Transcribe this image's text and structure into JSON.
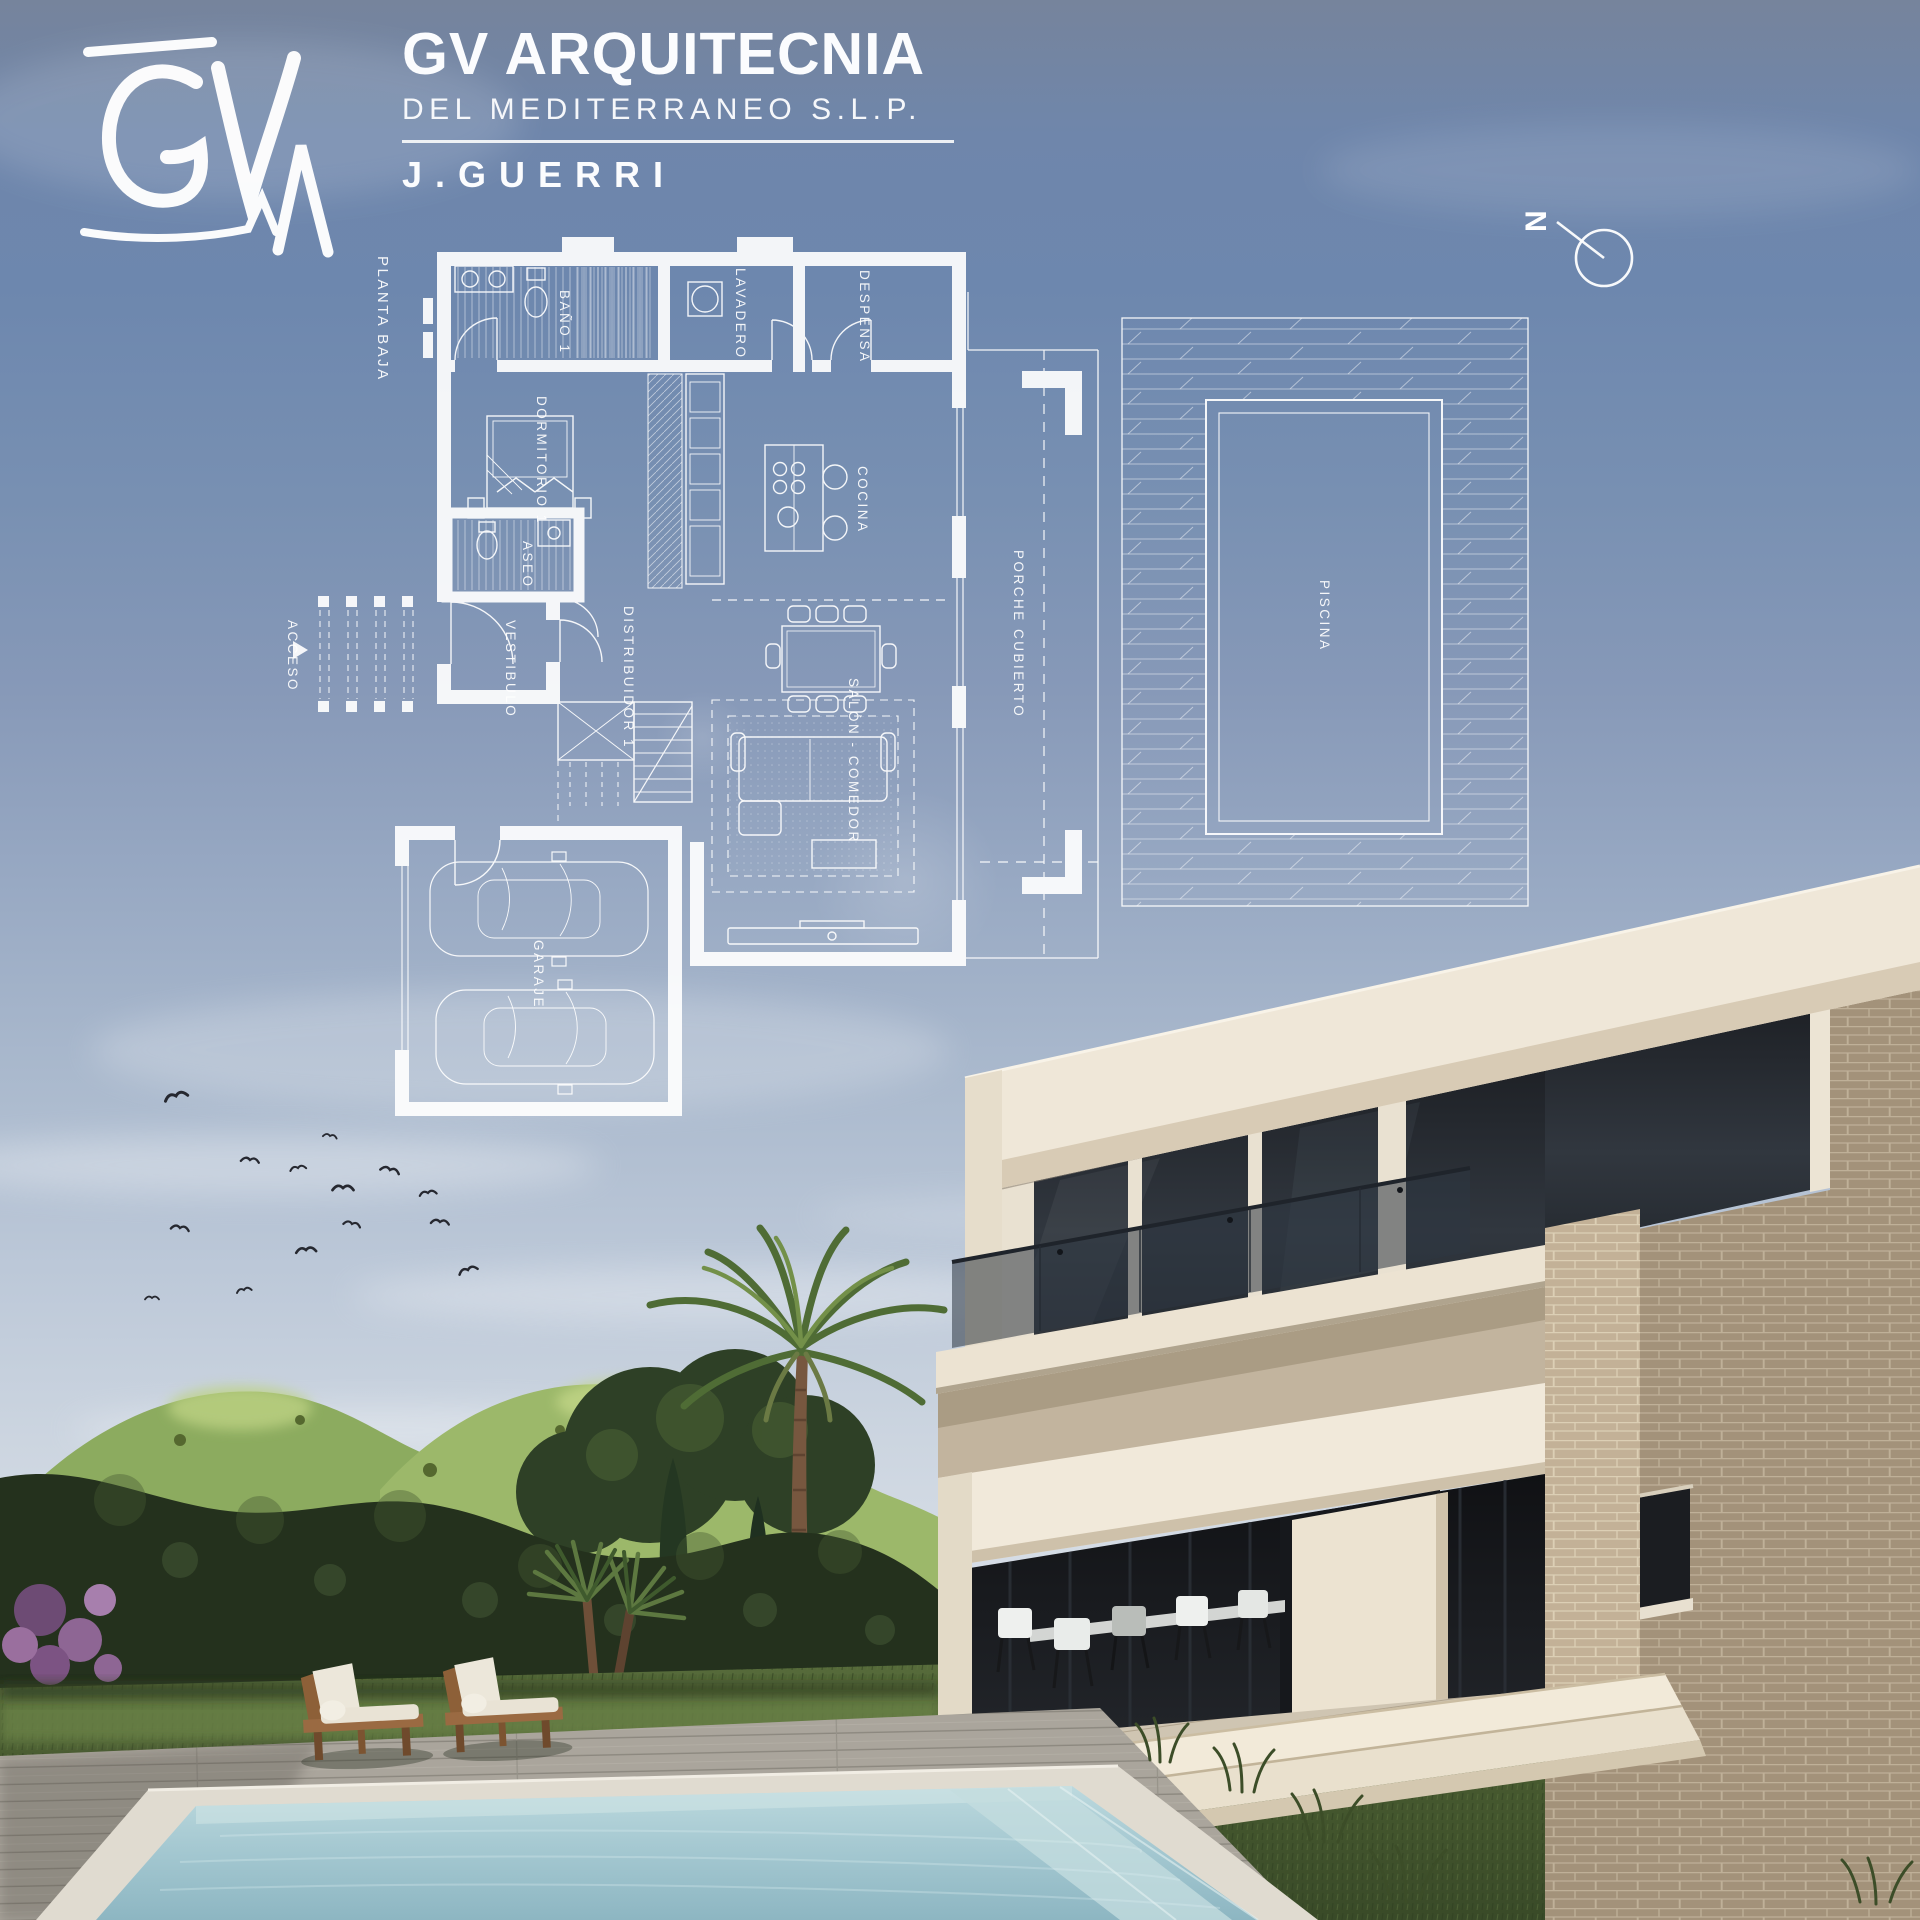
{
  "header": {
    "logo_text": "GV",
    "company_name": "GV ARQUITECNIA",
    "company_subtitle": "DEL MEDITERRANEO S.L.P.",
    "architect_name": "J.GUERRI"
  },
  "plan": {
    "title": "PLANTA BAJA",
    "north_label": "N",
    "rooms": [
      {
        "id": "bano1",
        "label": "BAÑO 1"
      },
      {
        "id": "lavadero",
        "label": "LAVADERO"
      },
      {
        "id": "despensa",
        "label": "DESPENSA"
      },
      {
        "id": "dormitorio1",
        "label": "DORMITORIO 1"
      },
      {
        "id": "aseo",
        "label": "ASEO"
      },
      {
        "id": "vestibulo",
        "label": "VESTIBULO"
      },
      {
        "id": "distribuidor1",
        "label": "DISTRIBUIDOR 1"
      },
      {
        "id": "cocina",
        "label": "COCINA"
      },
      {
        "id": "salon_comedor",
        "label": "SALÓN - COMEDOR"
      },
      {
        "id": "porche_cubierto",
        "label": "PORCHE CUBIERTO"
      },
      {
        "id": "piscina",
        "label": "PISCINA"
      },
      {
        "id": "garaje",
        "label": "GARAJE"
      },
      {
        "id": "acceso",
        "label": "ACCESO"
      }
    ]
  },
  "colors": {
    "sky_top": "#76849c",
    "sky_blue": "#6d87ae",
    "sky_horizon": "#dadfe8",
    "plan_line": "#ffffff",
    "house_cream": "#efe7d8",
    "house_shadow": "#c9bda9",
    "glass_dark": "#23262b",
    "brick": "#b5a48b",
    "brick_shadow": "#a08f77",
    "grass": "#47592f",
    "grass_light": "#6b8247",
    "hedge": "#24311d",
    "hills": "#8cab5f",
    "pool_water": "#a9cdd6",
    "pool_deep": "#8db6c2",
    "deck": "#b3aea4",
    "wood_frame": "#8d6038",
    "cushion": "#ece7da",
    "bird": "#262830"
  }
}
